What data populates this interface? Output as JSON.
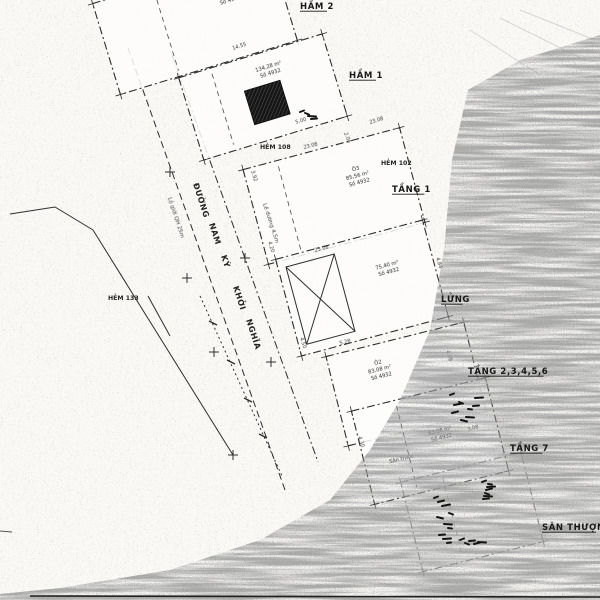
{
  "colors": {
    "paper": "#faf9f6",
    "ink": "#2e2e2e",
    "label_ink": "#171717",
    "noise_gray": "#8f8f8f",
    "hatch_dark": "#161616"
  },
  "floor_labels": [
    {
      "id": "ham-2",
      "text": "HẦM 2",
      "x": 300,
      "y": 9
    },
    {
      "id": "ham-1",
      "text": "HẦM 1",
      "x": 349,
      "y": 78
    },
    {
      "id": "tang-1",
      "text": "TẦNG 1",
      "x": 392,
      "y": 192
    },
    {
      "id": "lung",
      "text": "LỬNG",
      "x": 441,
      "y": 302
    },
    {
      "id": "tang-2-6",
      "text": "TẦNG 2,3,4,5,6",
      "x": 468,
      "y": 374
    },
    {
      "id": "tang-7",
      "text": "TẦNG 7",
      "x": 510,
      "y": 451
    },
    {
      "id": "san-thuong",
      "text": "SÂN THƯỢNG",
      "x": 542,
      "y": 530
    }
  ],
  "alley_labels": [
    {
      "id": "hem-108",
      "text": "HẺM 108",
      "x": 260,
      "y": 149
    },
    {
      "id": "hem-102",
      "text": "HẺM 102",
      "x": 381,
      "y": 165
    },
    {
      "id": "hem-133",
      "text": "HẺM 133",
      "x": 108,
      "y": 300
    }
  ],
  "street": {
    "words": [
      {
        "text": "ĐƯỜNG",
        "x": 193,
        "y": 184
      },
      {
        "text": "NAM",
        "x": 209,
        "y": 224
      },
      {
        "text": "KỲ",
        "x": 221,
        "y": 256
      },
      {
        "text": "KHỞI",
        "x": 233,
        "y": 287
      },
      {
        "text": "NGHĨA",
        "x": 246,
        "y": 320
      }
    ],
    "notes": [
      {
        "text": "Lộ giới QH 25m",
        "x": 168,
        "y": 198
      },
      {
        "text": "Lề đường 4,5m",
        "x": 263,
        "y": 204
      }
    ],
    "lines": [
      {
        "pts": "128,48 285,490",
        "dash": "7 4"
      },
      {
        "pts": "172,55 318,462",
        "dash": "8 3 2 3"
      },
      {
        "pts": "93,230 233,455",
        "dash": ""
      },
      {
        "pts": "10,214 55,207 93,230",
        "dash": ""
      },
      {
        "pts": "200,296 282,476",
        "dash": "2 3"
      },
      {
        "pts": "148,296 170,336",
        "dash": ""
      }
    ],
    "crosses": [
      {
        "x": 170,
        "y": 172
      },
      {
        "x": 187,
        "y": 278
      },
      {
        "x": 214,
        "y": 352
      },
      {
        "x": 245,
        "y": 258
      },
      {
        "x": 271,
        "y": 362
      },
      {
        "x": 233,
        "y": 455
      }
    ],
    "ticks": [
      {
        "x": 213,
        "y": 323
      },
      {
        "x": 231,
        "y": 362
      },
      {
        "x": 248,
        "y": 400
      },
      {
        "x": 263,
        "y": 436
      }
    ]
  },
  "plans": [
    {
      "id": "ham-2",
      "cx": 195,
      "cy": 22,
      "w": 185,
      "h": 95,
      "a": -17,
      "faint": false,
      "center": [
        {
          "t": "173,75 m²",
          "dx": 40,
          "dy": -16
        },
        {
          "t": "Số 4975",
          "dx": 40,
          "dy": -9
        }
      ],
      "inner": [
        {
          "type": "vline",
          "dx": -30
        }
      ]
    },
    {
      "id": "ham-1",
      "cx": 263,
      "cy": 97,
      "w": 150,
      "h": 86,
      "a": -17,
      "faint": false,
      "center": [
        {
          "t": "134,28 m²",
          "dx": 14,
          "dy": -26
        },
        {
          "t": "Số 4932",
          "dx": 14,
          "dy": -19
        }
      ],
      "inner": [
        {
          "type": "hatch",
          "dx": -16,
          "dy": -11,
          "w": 37,
          "h": 35
        },
        {
          "type": "vline",
          "dx": -42
        }
      ]
    },
    {
      "id": "tang-1",
      "cx": 334,
      "cy": 196,
      "w": 162,
      "h": 98,
      "a": -15,
      "faint": false,
      "center": [
        {
          "t": "Ô3",
          "dx": 28,
          "dy": -19
        },
        {
          "t": "85,56 m²",
          "dx": 28,
          "dy": -12
        },
        {
          "t": "Số 4932",
          "dx": 28,
          "dy": -5
        }
      ],
      "inner": [
        {
          "type": "vline",
          "dx": -46
        }
      ]
    },
    {
      "id": "lung",
      "cx": 362,
      "cy": 288,
      "w": 152,
      "h": 100,
      "a": -15,
      "faint": false,
      "center": [
        {
          "t": "75,40 m²",
          "dx": 30,
          "dy": -14
        },
        {
          "t": "Số 4932",
          "dx": 30,
          "dy": -7
        }
      ],
      "inner": [
        {
          "type": "xbox",
          "dx": -68,
          "dy": -40,
          "w": 50,
          "h": 80
        }
      ]
    },
    {
      "id": "tang-2-6",
      "cx": 406,
      "cy": 384,
      "w": 142,
      "h": 92,
      "a": -14,
      "faint": false,
      "center": [
        {
          "t": "Ô2",
          "dx": -22,
          "dy": -26
        },
        {
          "t": "83,08 m²",
          "dx": -22,
          "dy": -19
        },
        {
          "t": "Số 4932",
          "dx": -22,
          "dy": -12
        }
      ],
      "inner": []
    },
    {
      "id": "tang-7",
      "cx": 430,
      "cy": 441,
      "w": 138,
      "h": 96,
      "a": -14,
      "faint": false,
      "center": [
        {
          "t": "Sân trước",
          "dx": -32,
          "dy": 12
        },
        {
          "t": "83,08 m²",
          "dx": 12,
          "dy": -6
        },
        {
          "t": "Số 4932",
          "dx": 12,
          "dy": 1
        }
      ],
      "inner": [
        {
          "type": "vline",
          "dx": -24
        }
      ]
    },
    {
      "id": "san-thuong",
      "cx": 472,
      "cy": 512,
      "w": 124,
      "h": 92,
      "a": -14,
      "faint": true,
      "center": [],
      "inner": [
        {
          "type": "vline",
          "dx": -20
        }
      ]
    }
  ],
  "dims": [
    {
      "t": "23.08",
      "x": 304,
      "y": 149,
      "r": -14
    },
    {
      "t": "3.92",
      "x": 251,
      "y": 171,
      "r": 73
    },
    {
      "t": "14.55",
      "x": 233,
      "y": 50,
      "r": -18
    },
    {
      "t": "5.00",
      "x": 296,
      "y": 124,
      "r": -17
    },
    {
      "t": "2.06",
      "x": 344,
      "y": 133,
      "r": 70
    },
    {
      "t": "23.08",
      "x": 370,
      "y": 124,
      "r": -17
    },
    {
      "t": "4.20",
      "x": 268,
      "y": 242,
      "r": 73
    },
    {
      "t": "23.08",
      "x": 315,
      "y": 252,
      "r": -14
    },
    {
      "t": "5.28",
      "x": 340,
      "y": 345,
      "r": -14
    },
    {
      "t": "4.84",
      "x": 436,
      "y": 258,
      "r": 73
    },
    {
      "t": "4.08",
      "x": 446,
      "y": 351,
      "r": 73
    },
    {
      "t": "4.30",
      "x": 358,
      "y": 437,
      "r": 73
    },
    {
      "t": "3.08",
      "x": 468,
      "y": 431,
      "r": -14
    },
    {
      "t": "4.50",
      "x": 300,
      "y": 338,
      "r": 73
    }
  ],
  "smudges": [
    {
      "x": 450,
      "y": 395,
      "w": 30,
      "h": 26,
      "n": 9
    },
    {
      "x": 434,
      "y": 498,
      "w": 16,
      "h": 48,
      "n": 10
    },
    {
      "x": 482,
      "y": 482,
      "w": 26,
      "h": 20,
      "n": 7
    },
    {
      "x": 300,
      "y": 112,
      "w": 14,
      "h": 10,
      "n": 4
    },
    {
      "x": 460,
      "y": 540,
      "w": 22,
      "h": 12,
      "n": 5
    }
  ],
  "artifacts": {
    "band": "600,35 520,60 468,90 452,160 444,250 430,330 400,400 370,450 330,500 260,540 170,570 60,588 0,594 0,600 600,600",
    "scratches": [
      "500,18 585,60",
      "520,10 595,40",
      "470,30 540,75"
    ],
    "bottom_line": {
      "x1": 30,
      "y1": 596,
      "x2": 600,
      "y2": 597
    },
    "corner_mark": {
      "x1": 0,
      "y1": 531,
      "x2": 12,
      "y2": 532
    }
  }
}
